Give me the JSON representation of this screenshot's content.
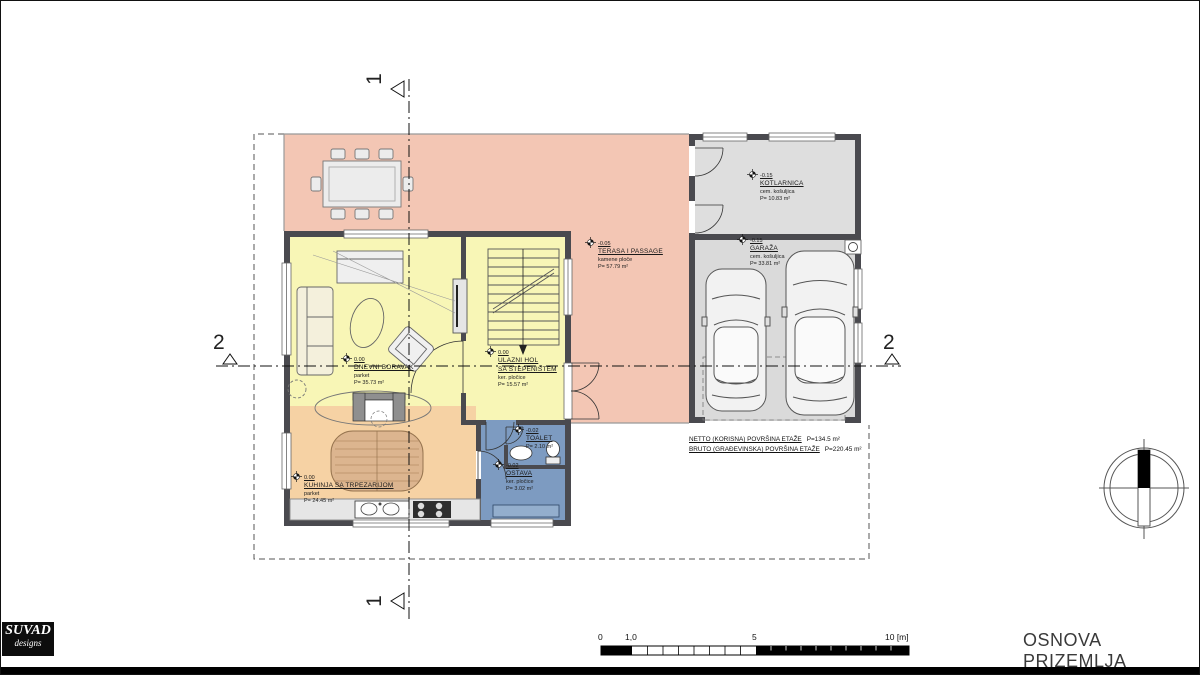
{
  "title_block": {
    "title": "OSNOVA PRIZEMLJA"
  },
  "logo": {
    "name": "SUVAD",
    "sub": "designs"
  },
  "section_markers": {
    "one": "1",
    "two": "2"
  },
  "rooms": {
    "terasa": {
      "elev": "-0.05",
      "name": "TERASA I PASSAGE",
      "finish": "kamene ploče",
      "area": "P= 57.79 m²"
    },
    "dnevni": {
      "elev": "0.00",
      "name": "DNEVNI BORAVAK",
      "finish": "parket",
      "area": "P= 35.73 m²"
    },
    "hol": {
      "elev": "0.00",
      "name": "ULAZNI HOL",
      "name2": "SA STEPENIŠTEM",
      "finish": "ker. pločice",
      "area": "P= 15.57 m²"
    },
    "kuhinja": {
      "elev": "0.00",
      "name": "KUHINJA SA TRPEZARIJOM",
      "finish": "parket",
      "area": "P= 24.45 m²"
    },
    "toalet": {
      "elev": "-0.02",
      "name": "TOALET",
      "finish": "ker. pl.",
      "area": "P= 2.10 m²"
    },
    "ostava": {
      "elev": "-0.02",
      "name": "OSTAVA",
      "finish": "ker. pločice",
      "area": "P= 3.02 m²"
    },
    "garaza": {
      "elev": "-0.15",
      "name": "GARAŽA",
      "finish": "cem. košuljica",
      "area": "P= 33.81 m²"
    },
    "kotlarnica": {
      "elev": "-0.15",
      "name": "KOTLARNICA",
      "finish": "cem. košuljica",
      "area": "P= 10.83 m²"
    }
  },
  "summary": {
    "netto_label": "NETTO (KORISNA) POVRŠINA ETAŽE",
    "netto_value": "P=134.5 m²",
    "bruto_label": "BRUTO (GRAĐEVINSKA) POVRŠINA ETAŽE",
    "bruto_value": "P=220.45 m²"
  },
  "scalebar": {
    "t0": "0",
    "t1": "1,0",
    "t5": "5",
    "t10": "10 [m]"
  },
  "colors": {
    "terrace": "#f3c6b4",
    "living": "#f8f6b6",
    "kitchen": "#f6d2a4",
    "wet": "#7d9bc1",
    "garage": "#dadada",
    "wall": "#4a4a4f"
  }
}
